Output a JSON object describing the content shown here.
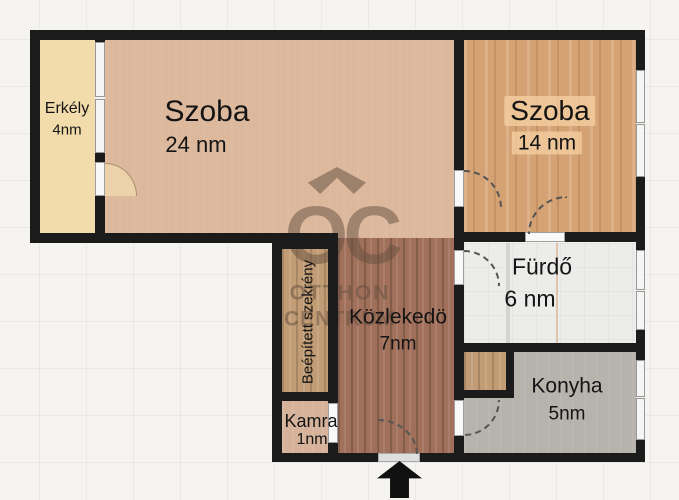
{
  "floorplan": {
    "rooms": {
      "erkely": {
        "name": "Erkély",
        "area": "4nm"
      },
      "szoba24": {
        "name": "Szoba",
        "area": "24 nm"
      },
      "szoba14": {
        "name": "Szoba",
        "area": "14 nm"
      },
      "szekreny": {
        "name": "Beépített szekrény"
      },
      "kozlekedo": {
        "name": "Közlekedö",
        "area": "7nm"
      },
      "furdo": {
        "name": "Fürdő",
        "area": "6 nm"
      },
      "kamra": {
        "name": "Kamra",
        "area": "1nm"
      },
      "konyha": {
        "name": "Konyha",
        "area": "5nm"
      }
    },
    "watermark": {
      "brand": "OC",
      "line1": "OTTHON",
      "line2": "CENTRUM"
    },
    "colors": {
      "canvas": "#f5f4f1",
      "wall": "#1b1b1b",
      "balcony_floor": "#f3dcab",
      "szoba24_floor": "#dcb89d",
      "szoba14_floor": "#d5a273",
      "hallway_floor": "#a1705a",
      "wardrobe_floor": "#c29c74",
      "kamra_floor": "#d6b29a",
      "bathroom_floor": "#ececea",
      "kitchen_floor": "#b6b2ac",
      "arrow": "#111111"
    }
  }
}
